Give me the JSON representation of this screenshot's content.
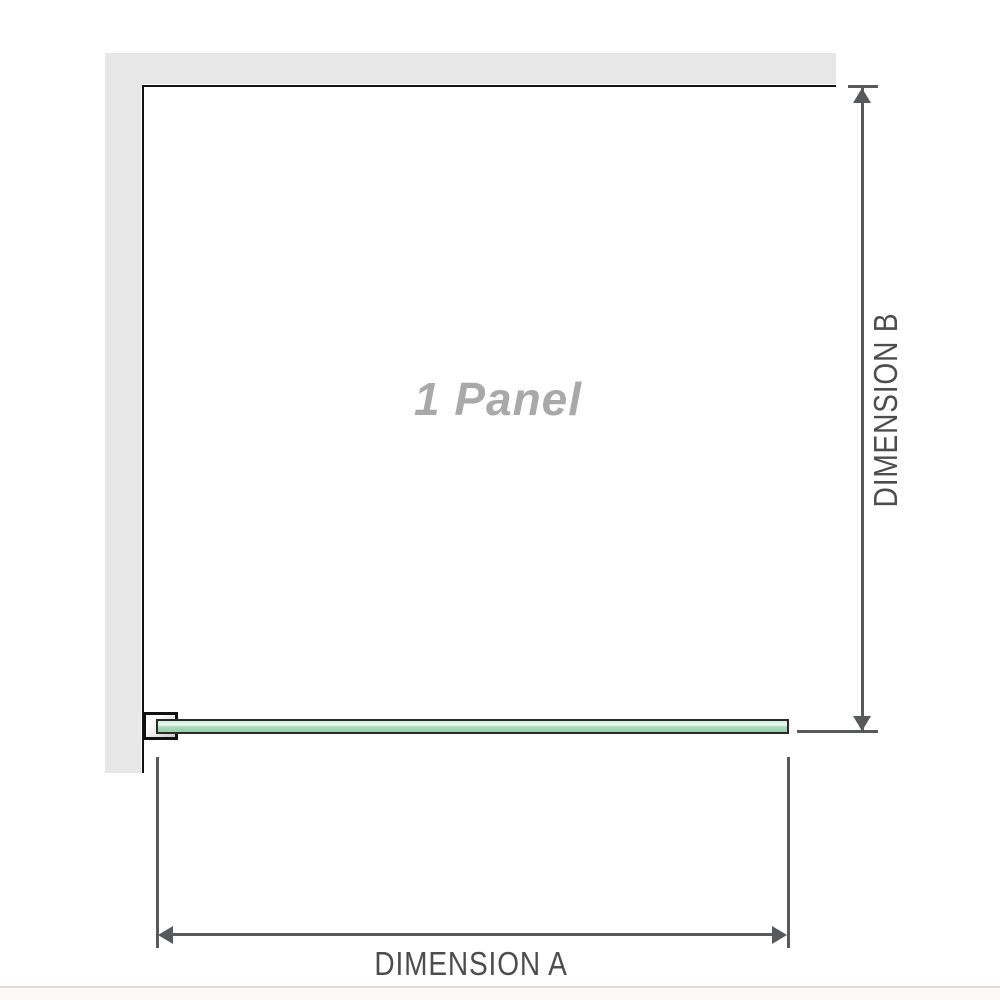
{
  "diagram": {
    "title": "1 Panel shower screen dimension diagram",
    "panel_label": "1 Panel",
    "dimension_a_label": "DIMENSION A",
    "dimension_b_label": "DIMENSION B"
  },
  "colors": {
    "wall": "#e7e7e7",
    "outline": "#141414",
    "dimension": "#58595b",
    "label_text": "#4d4d4d",
    "panel_label_text": "#a9a9a9",
    "glass_border": "#2b2b2b",
    "glass_green": "#a6dab8",
    "glass_highlight": "#eef9f2"
  }
}
